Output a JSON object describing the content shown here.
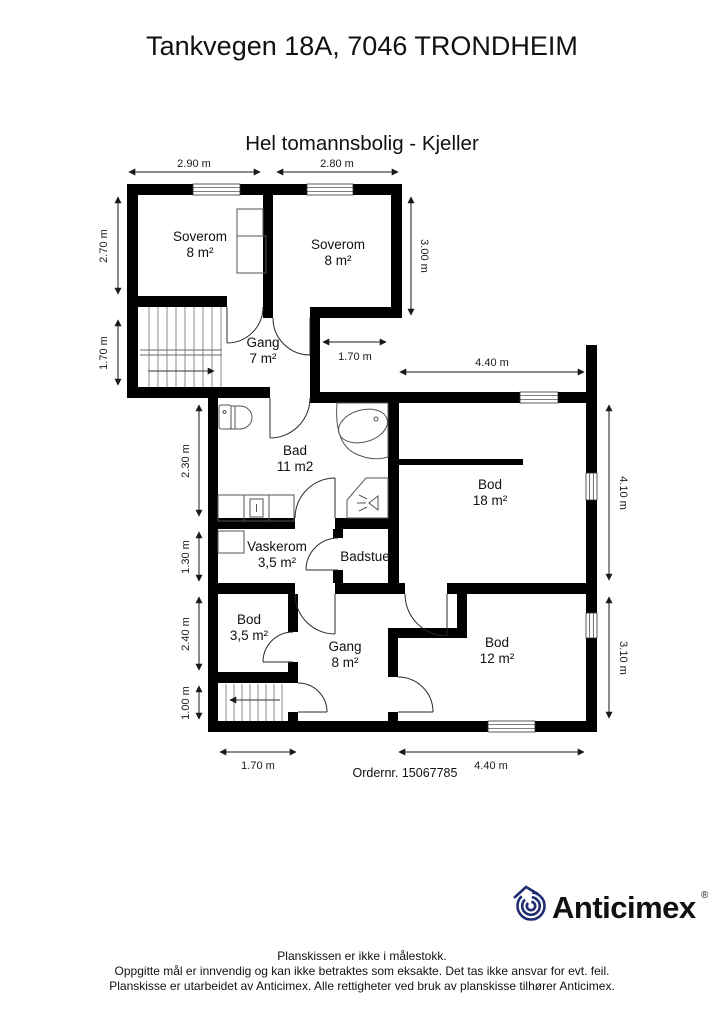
{
  "header": {
    "title": "Tankvegen 18A, 7046 TRONDHEIM",
    "subtitle": "Hel tomannsbolig - Kjeller"
  },
  "rooms": [
    {
      "name": "Soverom",
      "area": "8 m²"
    },
    {
      "name": "Soverom",
      "area": "8 m²"
    },
    {
      "name": "Gang",
      "area": "7 m²"
    },
    {
      "name": "Bad",
      "area": "11 m2"
    },
    {
      "name": "Bod",
      "area": "18 m²"
    },
    {
      "name": "Vaskerom",
      "area": "3,5 m²"
    },
    {
      "name": "Badstue",
      "area": ""
    },
    {
      "name": "Bod",
      "area": "3,5 m²"
    },
    {
      "name": "Gang",
      "area": "8 m²"
    },
    {
      "name": "Bod",
      "area": "12 m²"
    }
  ],
  "dims": {
    "soverom1_width": "2.90 m",
    "soverom2_width": "2.80 m",
    "soverom1_height": "2.70 m",
    "stairs_height": "1.70 m",
    "soverom2_height": "3.00 m",
    "notch_width": "1.70 m",
    "bod18_width": "4.40 m",
    "bad_height": "2.30 m",
    "vaskerom_height": "1.30 m",
    "bod35_height": "2.40 m",
    "stairs2_height": "1.00 m",
    "bod18_height": "4.10 m",
    "bod12_height": "3.10 m",
    "bottom_left_width": "1.70 m",
    "bod12_width": "4.40 m"
  },
  "order": {
    "label": "Ordernr. 15067785"
  },
  "logo": {
    "name": "Anticimex",
    "registered": "®",
    "color": "#212d72"
  },
  "footer": {
    "line1": "Planskissen er ikke i målestokk.",
    "line2": "Oppgitte mål er innvendig og kan ikke betraktes som eksakte. Det tas ikke ansvar for evt. feil.",
    "line3": "Planskisse er utarbeidet av Anticimex. Alle rettigheter ved bruk av planskisse tilhører Anticimex."
  },
  "colors": {
    "wall": "#000000",
    "background": "#ffffff",
    "logo_navy": "#212d72",
    "text": "#111111"
  }
}
